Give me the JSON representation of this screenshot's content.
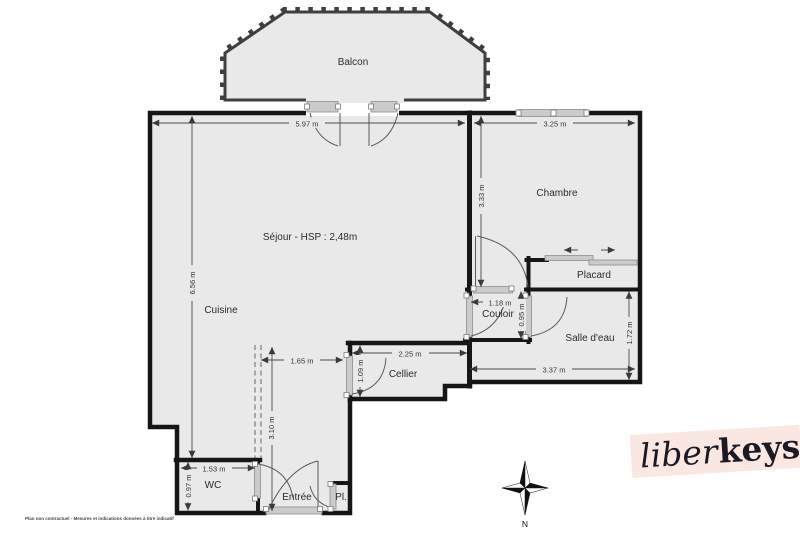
{
  "plan": {
    "rooms": [
      {
        "id": "balcon",
        "label": "Balcon"
      },
      {
        "id": "sejour",
        "label": "Séjour - HSP : 2,48m"
      },
      {
        "id": "chambre",
        "label": "Chambre"
      },
      {
        "id": "cuisine",
        "label": "Cuisine"
      },
      {
        "id": "placard",
        "label": "Placard"
      },
      {
        "id": "couloir",
        "label": "Couloir"
      },
      {
        "id": "salle-deau",
        "label": "Salle d'eau"
      },
      {
        "id": "cellier",
        "label": "Cellier"
      },
      {
        "id": "wc",
        "label": "WC"
      },
      {
        "id": "entree",
        "label": "Entrée"
      },
      {
        "id": "pl",
        "label": "Pl."
      }
    ],
    "dimensions": [
      {
        "id": "sejour-width",
        "label": "5.97 m"
      },
      {
        "id": "chambre-width",
        "label": "3.25 m"
      },
      {
        "id": "left-height",
        "label": "6.56 m"
      },
      {
        "id": "chambre-height",
        "label": "3.33 m"
      },
      {
        "id": "couloir-width",
        "label": "1.18 m"
      },
      {
        "id": "couloir-height",
        "label": "0.95 m"
      },
      {
        "id": "sde-height",
        "label": "1.72 m"
      },
      {
        "id": "sde-width",
        "label": "3.37 m"
      },
      {
        "id": "cellier-width",
        "label": "2.25 m"
      },
      {
        "id": "cellier-height",
        "label": "1.09 m"
      },
      {
        "id": "entree-width",
        "label": "1.65 m"
      },
      {
        "id": "entree-depth",
        "label": "3.10 m"
      },
      {
        "id": "wc-width",
        "label": "1.53 m"
      },
      {
        "id": "wc-height",
        "label": "0.97 m"
      }
    ],
    "compass": {
      "north_label": "N"
    },
    "branding": {
      "logo_script": "liber",
      "logo_bold": "keys"
    },
    "disclaimer": "Plan non contractuel - Mesures et indications données à titre indicatif",
    "colors": {
      "room_fill": "#e9e9e9",
      "wall": "#161616",
      "door": "#cbcbcb",
      "logo_bg": "#fbe7e1",
      "logo_text": "#1a1a24"
    }
  }
}
